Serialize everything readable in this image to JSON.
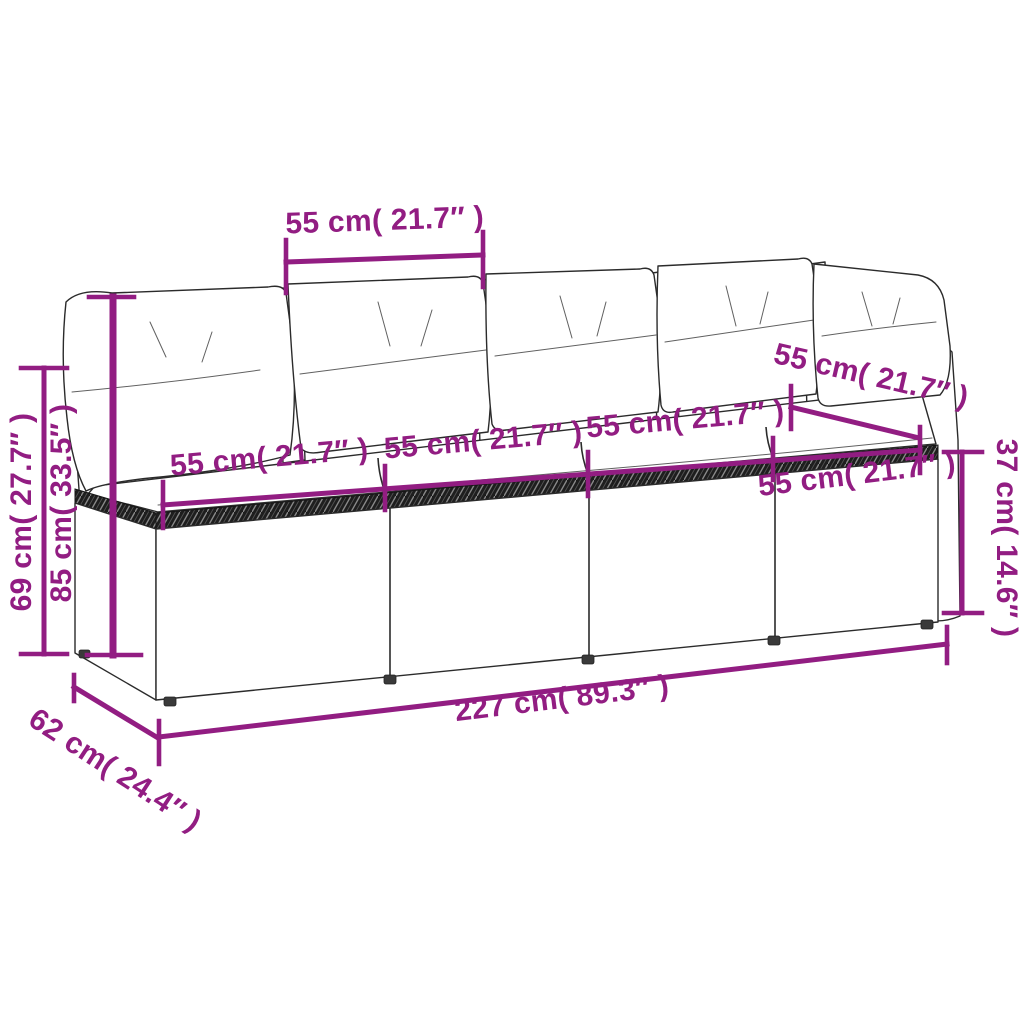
{
  "diagram": {
    "kind": "product-dimension-diagram",
    "subject": "four-seat-rattan-garden-sofa-with-back-and-seat-cushions"
  },
  "colors": {
    "dimension_accent": "#921d82",
    "line_art": "#2b2b2b",
    "background": "#ffffff",
    "cushion_fill": "#faf8f2"
  },
  "dimensions": {
    "top_back_seat_width": {
      "label": "55 cm( 21.7″ )",
      "cm": 55,
      "inches": 21.7
    },
    "back_frame_height": {
      "label": "69 cm( 27.7″ )",
      "cm": 69,
      "inches": 27.7
    },
    "total_height": {
      "label": "85 cm( 33.5″ )",
      "cm": 85,
      "inches": 33.5
    },
    "seat1_width": {
      "label": "55 cm( 21.7″ )",
      "cm": 55,
      "inches": 21.7
    },
    "seat2_width": {
      "label": "55 cm( 21.7″ )",
      "cm": 55,
      "inches": 21.7
    },
    "seat3_width": {
      "label": "55 cm( 21.7″ )",
      "cm": 55,
      "inches": 21.7
    },
    "seat4_width": {
      "label": "55 cm( 21.7″ )",
      "cm": 55,
      "inches": 21.7
    },
    "back_right_seat_width": {
      "label": "55 cm( 21.7″ )",
      "cm": 55,
      "inches": 21.7
    },
    "seat_height": {
      "label": "37 cm( 14.6″ )",
      "cm": 37,
      "inches": 14.6
    },
    "total_length": {
      "label": "227 cm( 89.3″ )",
      "cm": 227,
      "inches": 89.3
    },
    "depth": {
      "label": "62 cm( 24.4″ )",
      "cm": 62,
      "inches": 24.4
    }
  }
}
